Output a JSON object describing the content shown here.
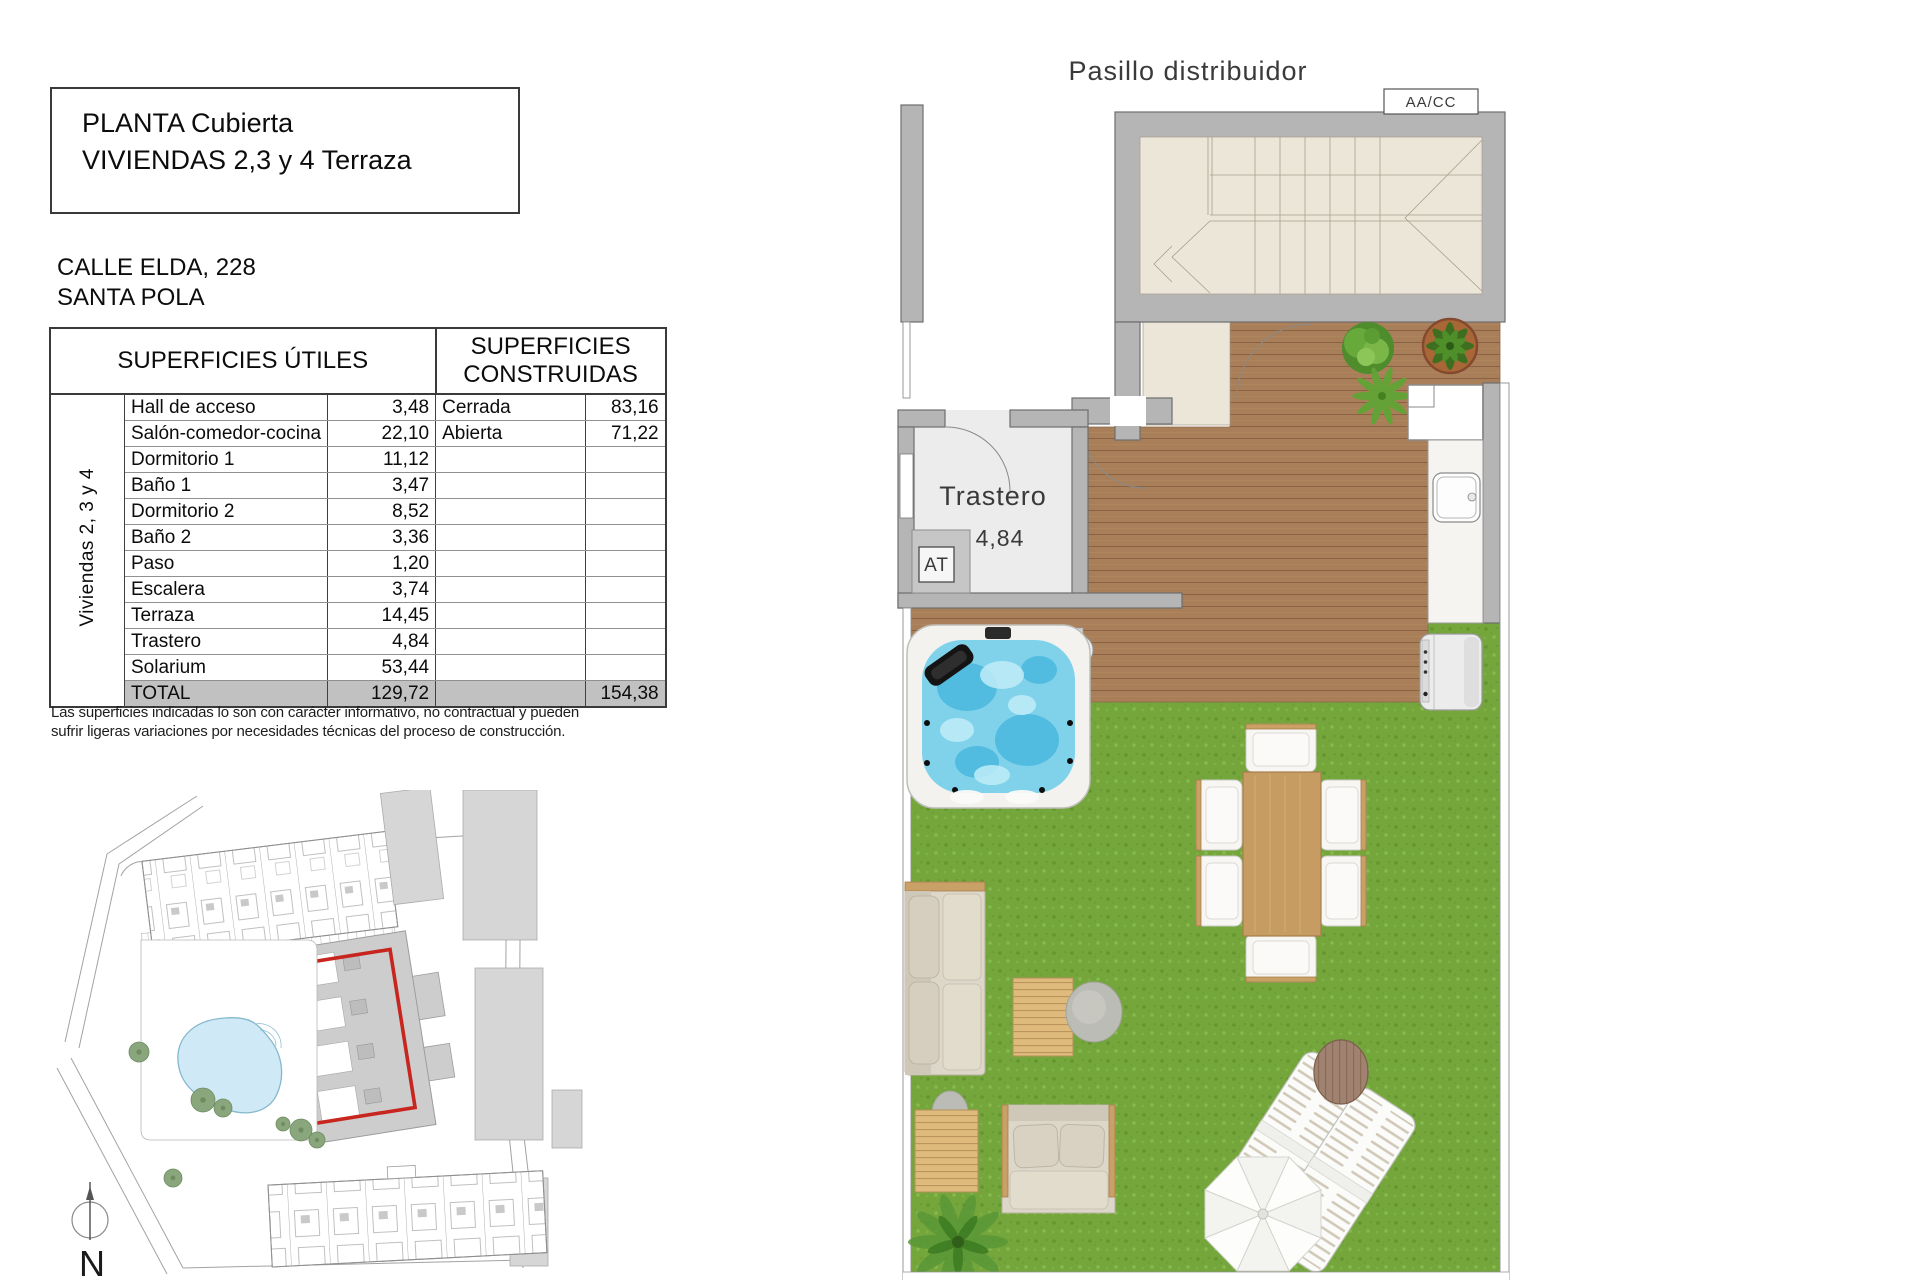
{
  "title_block": {
    "line1": "PLANTA Cubierta",
    "line2": "VIVIENDAS 2,3 y 4 Terraza"
  },
  "address": {
    "line1": "CALLE ELDA, 228",
    "line2": "SANTA POLA"
  },
  "surfaces_table": {
    "header_useful": "SUPERFICIES ÚTILES",
    "header_built": "SUPERFICIES CONSTRUIDAS",
    "group_label": "Viviendas 2, 3 y 4",
    "rows": [
      {
        "name": "Hall de acceso",
        "value": "3,48",
        "built_name": "Cerrada",
        "built_value": "83,16"
      },
      {
        "name": "Salón-comedor-cocina",
        "value": "22,10",
        "built_name": "Abierta",
        "built_value": "71,22"
      },
      {
        "name": "Dormitorio 1",
        "value": "11,12",
        "built_name": "",
        "built_value": ""
      },
      {
        "name": "Baño 1",
        "value": "3,47",
        "built_name": "",
        "built_value": ""
      },
      {
        "name": "Dormitorio 2",
        "value": "8,52",
        "built_name": "",
        "built_value": ""
      },
      {
        "name": "Baño 2",
        "value": "3,36",
        "built_name": "",
        "built_value": ""
      },
      {
        "name": "Paso",
        "value": "1,20",
        "built_name": "",
        "built_value": ""
      },
      {
        "name": "Escalera",
        "value": "3,74",
        "built_name": "",
        "built_value": ""
      },
      {
        "name": "Terraza",
        "value": "14,45",
        "built_name": "",
        "built_value": ""
      },
      {
        "name": "Trastero",
        "value": "4,84",
        "built_name": "",
        "built_value": ""
      },
      {
        "name": "Solarium",
        "value": "53,44",
        "built_name": "",
        "built_value": ""
      }
    ],
    "total": {
      "label": "TOTAL",
      "value": "129,72",
      "built_name": "",
      "built_value": "154,38"
    }
  },
  "disclaimer": "Las superficies indicadas lo son con carácter informativo, no contractual y pueden sufrir ligeras variaciones por necesidades técnicas del proceso de construcción.",
  "floor_plan": {
    "corridor_label": "Pasillo distribuidor",
    "hvac_label": "AA/CC",
    "storage_label": "Trastero",
    "storage_area": "4,84",
    "antenna_label": "AT"
  },
  "site_plan": {
    "north_label": "N"
  },
  "colors": {
    "accent_red": "#c8251f",
    "wall_gray": "#b5b5b5",
    "roof_beige": "#ece6d9",
    "deck_wood": "#a87f58",
    "lawn_green": "#74a63c",
    "spa_water": "#7fd2ea",
    "pool_blue": "#cfeaf6",
    "furniture_wood": "#c79c63",
    "total_row_gray": "#c1c1c1"
  }
}
